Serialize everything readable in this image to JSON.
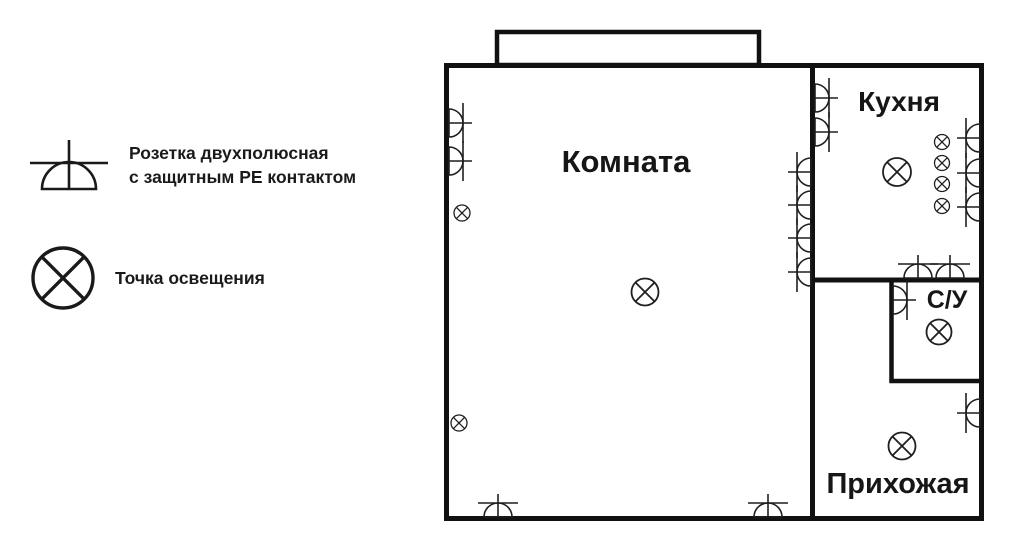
{
  "colors": {
    "ink": "#1f1f1f",
    "wall": "#111111"
  },
  "legend": {
    "items": [
      {
        "icon": "socket-pe-icon",
        "label": "Розетка двухполюсная\nс защитным PE контактом"
      },
      {
        "icon": "light-point-icon",
        "label": "Точка освещения"
      }
    ]
  },
  "plan": {
    "rooms": [
      {
        "id": "komnata",
        "label": "Комната",
        "x": 626,
        "y": 172,
        "size": 31
      },
      {
        "id": "kuhnya",
        "label": "Кухня",
        "x": 899,
        "y": 111,
        "size": 28
      },
      {
        "id": "su",
        "label": "С/У",
        "x": 947,
        "y": 308,
        "size": 25
      },
      {
        "id": "prihozhaya",
        "label": "Прихожая",
        "x": 898,
        "y": 493,
        "size": 29
      }
    ],
    "sockets": [
      {
        "x": 449,
        "y": 123,
        "dir": "right"
      },
      {
        "x": 449,
        "y": 161,
        "dir": "right"
      },
      {
        "x": 811,
        "y": 172,
        "dir": "left"
      },
      {
        "x": 811,
        "y": 205,
        "dir": "left"
      },
      {
        "x": 811,
        "y": 238,
        "dir": "left"
      },
      {
        "x": 811,
        "y": 272,
        "dir": "left"
      },
      {
        "x": 498,
        "y": 517,
        "dir": "up"
      },
      {
        "x": 768,
        "y": 517,
        "dir": "up"
      },
      {
        "x": 815,
        "y": 98,
        "dir": "right"
      },
      {
        "x": 815,
        "y": 132,
        "dir": "right"
      },
      {
        "x": 980,
        "y": 138,
        "dir": "left"
      },
      {
        "x": 980,
        "y": 173,
        "dir": "left"
      },
      {
        "x": 980,
        "y": 207,
        "dir": "left"
      },
      {
        "x": 918,
        "y": 278,
        "dir": "up"
      },
      {
        "x": 950,
        "y": 278,
        "dir": "up"
      },
      {
        "x": 893,
        "y": 300,
        "dir": "right"
      },
      {
        "x": 980,
        "y": 413,
        "dir": "left"
      }
    ],
    "lights": [
      {
        "x": 645,
        "y": 292,
        "r": 13.5
      },
      {
        "x": 897,
        "y": 172,
        "r": 14
      },
      {
        "x": 939,
        "y": 332,
        "r": 12.5
      },
      {
        "x": 902,
        "y": 446,
        "r": 13.5
      },
      {
        "x": 462,
        "y": 213,
        "r": 8
      },
      {
        "x": 459,
        "y": 423,
        "r": 8
      },
      {
        "x": 942,
        "y": 142,
        "r": 7.5
      },
      {
        "x": 942,
        "y": 163,
        "r": 7.5
      },
      {
        "x": 942,
        "y": 184,
        "r": 7.5
      },
      {
        "x": 942,
        "y": 206,
        "r": 7.5
      }
    ]
  }
}
